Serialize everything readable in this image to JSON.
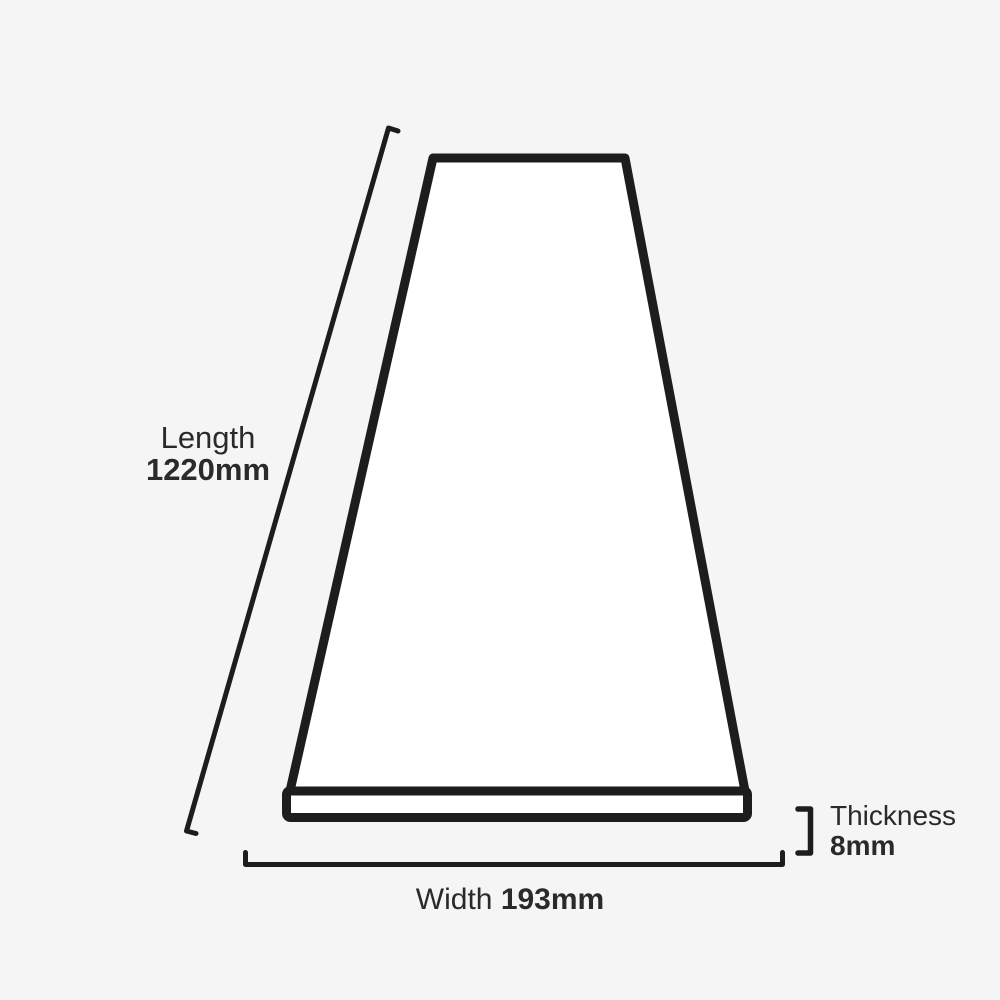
{
  "title": "Plank dimensions diagram",
  "colors": {
    "background": "#f5f5f5",
    "outline": "#1d1d1f",
    "plank_surface": "#ffffff",
    "text": "#2a2a2c"
  },
  "diagram": {
    "shape": "plank-perspective-view",
    "dimensions": {
      "length": {
        "label": "Length",
        "value": "1220mm"
      },
      "width": {
        "label": "Width",
        "value": "193mm"
      },
      "thickness": {
        "label": "Thickness",
        "value": "8mm"
      }
    }
  }
}
